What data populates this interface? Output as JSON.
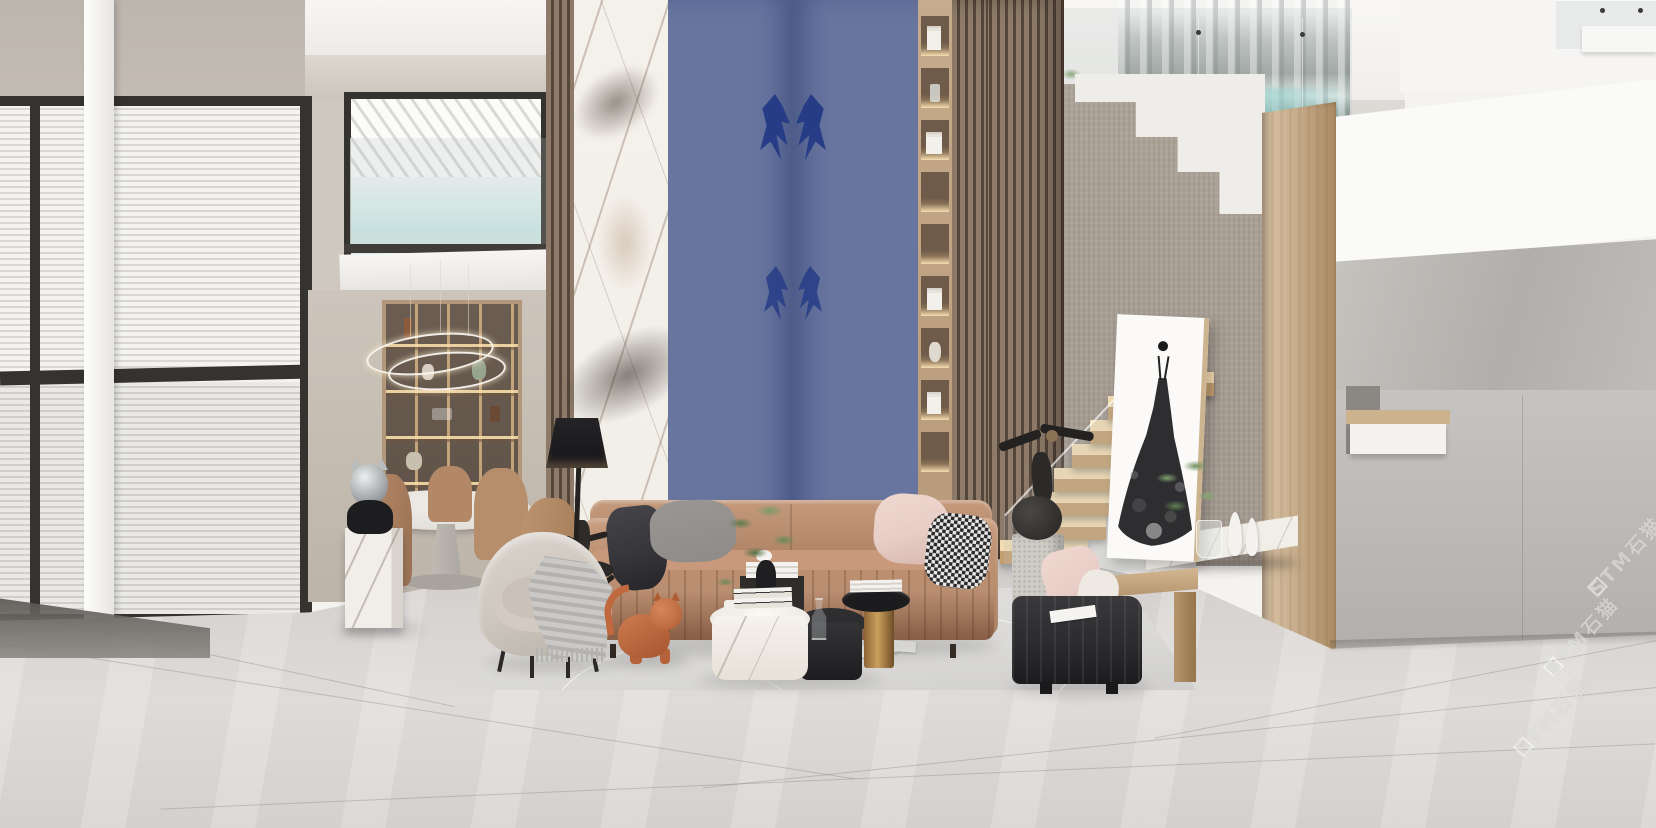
{
  "scene": {
    "watermark": {
      "text": "STM石猫",
      "repeat_count": 3
    },
    "palette": {
      "ceiling": "#f5f3f0",
      "wall_left": "#bdb6ae",
      "wall_alcove": "#c6c3c0",
      "wall_stair": "#a49a90",
      "frame_dark": "#35332f",
      "blinds_light": "#f4f3f1",
      "blinds_shade": "#d9d7d4",
      "sky": "#cde9e6",
      "slat_wood": "#8d7a69",
      "slat_gap": "#55463a",
      "marble_white": "#f2eee8",
      "sodalite_base": "#68759f",
      "sodalite_deep": "#263c86",
      "niche_wood": "#c6ab8c",
      "niche_dark": "#6e5b49",
      "niche_glow": "#f5ddb0",
      "cabinet_wood": "#b2977a",
      "cabinet_dark": "#5f5248",
      "sofa": "#b98e71",
      "sofa_dark": "#8a6148",
      "pillow_dark": "#37363a",
      "pillow_gray": "#8f8b88",
      "pillow_blush": "#e7cdc5",
      "hound_dark": "#2b2b2d",
      "hound_light": "#e8e6e2",
      "bench": "#2a292c",
      "bench_wood": "#b3946f",
      "rug": "#dbdad8",
      "floor": "#d6d3d0",
      "tread_light": "#f4dcb2",
      "tread_dark": "#c49e6f",
      "stringer": "#dcdad7",
      "glass_tint": "rgba(187,196,196,0.22)",
      "art_canvas": "#fbfaf8",
      "wood_panel": "#c8ae8d",
      "gold": "#caa05c",
      "cat": "#c0693f",
      "armchair": "#cfc8c0",
      "throw": "#b4b2b0",
      "lamp": "#161518",
      "white_box": "#fafaf9",
      "sculpture_dark": "#2b2a28",
      "stone": "#cfccc6",
      "watermark": "rgba(255,255,255,0.5)"
    }
  }
}
